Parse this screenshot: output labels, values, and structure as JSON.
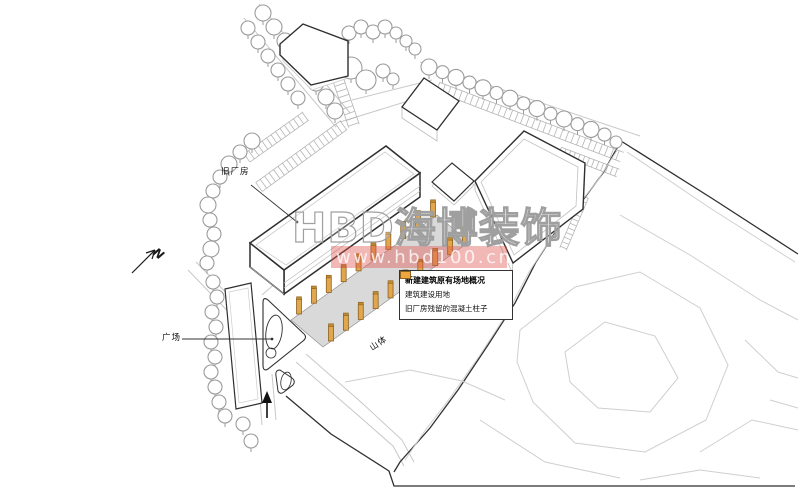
{
  "page": {
    "width": 800,
    "height": 490,
    "background": "#ffffff"
  },
  "plan": {
    "north_label": "N",
    "labels": {
      "old_factory": "旧厂房",
      "plaza": "广场",
      "mountain": "山体"
    },
    "legend": {
      "title": "新建建筑原有场地概况",
      "items": [
        {
          "label": "建筑建设用地",
          "color": "#c9c9c9"
        },
        {
          "label": "旧厂房残留的混凝土柱子",
          "color": "#f0a63c"
        }
      ]
    },
    "watermark": {
      "brand": "HBD海博装饰",
      "url": "www.hbd100.cn",
      "band_color": "#e0564e"
    },
    "colors": {
      "column_fill": "#e2a74d",
      "column_stroke": "#8a6224",
      "column_cap": "#c08a2f",
      "pad_fill": "#d9d9d9",
      "tree_stroke": "#9b9b9b",
      "road_stroke": "#c8c8c8",
      "contour_stroke": "#cfcfcf",
      "dark_stroke": "#2f2f2f"
    }
  }
}
